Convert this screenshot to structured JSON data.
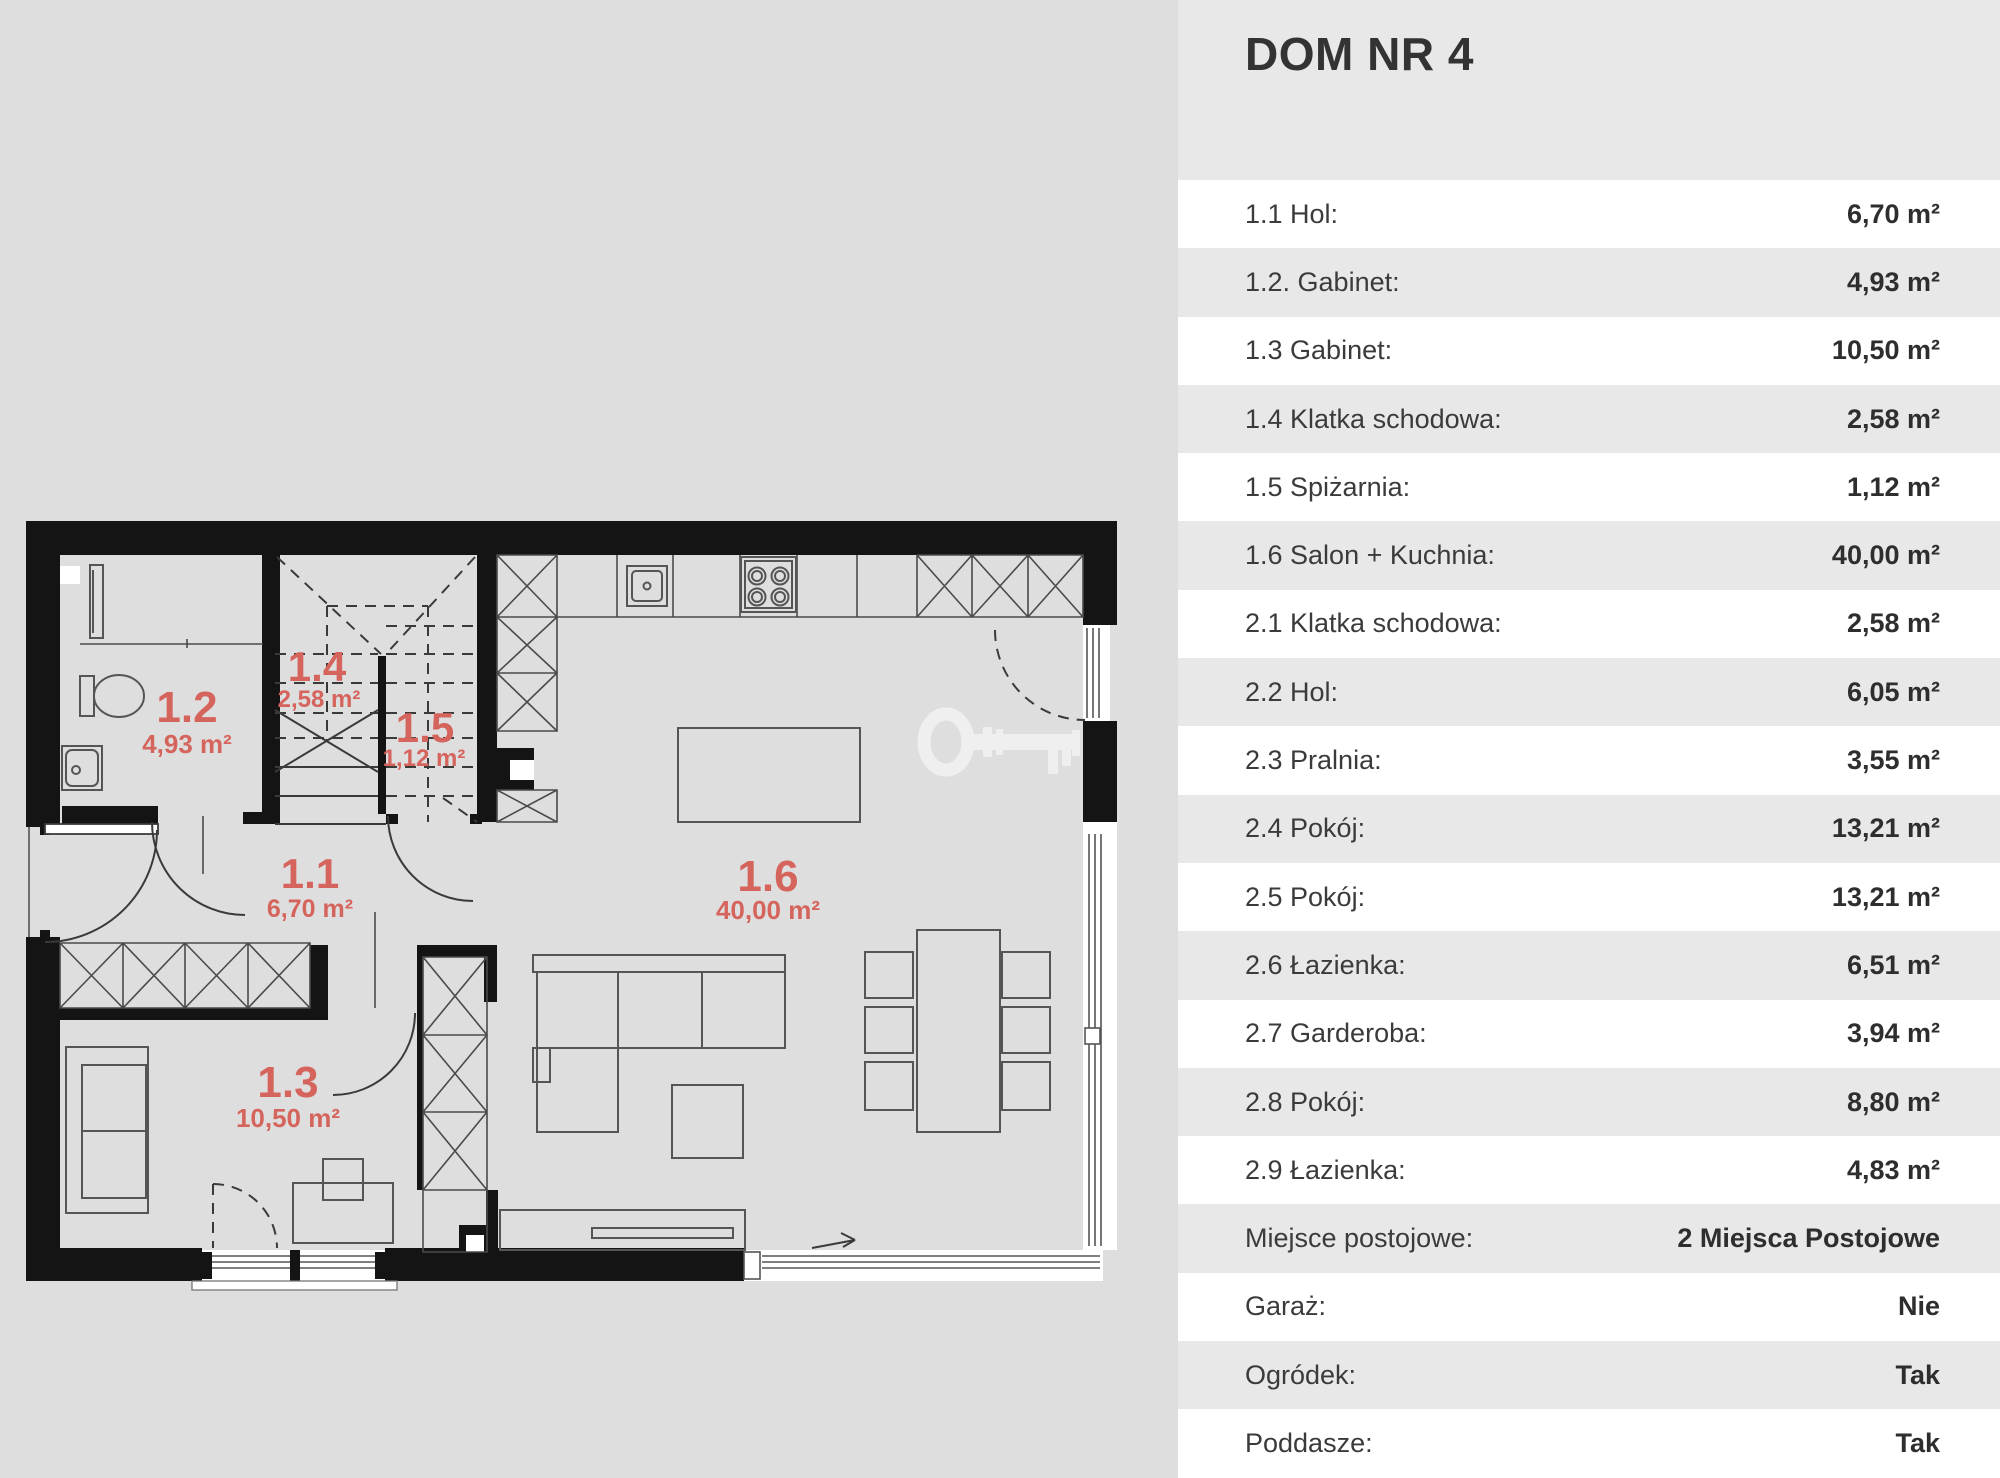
{
  "title": "DOM NR 4",
  "plan": {
    "rooms": [
      {
        "id": "1.1",
        "area": "6,70 m²"
      },
      {
        "id": "1.2",
        "area": "4,93 m²"
      },
      {
        "id": "1.3",
        "area": "10,50 m²"
      },
      {
        "id": "1.4",
        "area": "2,58 m²"
      },
      {
        "id": "1.5",
        "area": "1,12 m²"
      },
      {
        "id": "1.6",
        "area": "40,00 m²"
      }
    ],
    "watermark": "key-icon"
  },
  "table": {
    "rows": [
      {
        "label": "1.1 Hol:",
        "value": "6,70 m²"
      },
      {
        "label": "1.2. Gabinet:",
        "value": "4,93 m²"
      },
      {
        "label": "1.3 Gabinet:",
        "value": "10,50 m²"
      },
      {
        "label": "1.4 Klatka schodowa:",
        "value": "2,58 m²"
      },
      {
        "label": "1.5 Spiżarnia:",
        "value": "1,12 m²"
      },
      {
        "label": "1.6 Salon + Kuchnia:",
        "value": "40,00 m²"
      },
      {
        "label": "2.1 Klatka schodowa:",
        "value": "2,58 m²"
      },
      {
        "label": "2.2 Hol:",
        "value": "6,05 m²"
      },
      {
        "label": "2.3 Pralnia:",
        "value": "3,55 m²"
      },
      {
        "label": "2.4 Pokój:",
        "value": "13,21 m²"
      },
      {
        "label": "2.5 Pokój:",
        "value": "13,21 m²"
      },
      {
        "label": "2.6 Łazienka:",
        "value": "6,51 m²"
      },
      {
        "label": "2.7 Garderoba:",
        "value": "3,94 m²"
      },
      {
        "label": "2.8 Pokój:",
        "value": "8,80 m²"
      },
      {
        "label": "2.9 Łazienka:",
        "value": "4,83 m²"
      },
      {
        "label": "Miejsce postojowe:",
        "value": "2 Miejsca Postojowe"
      },
      {
        "label": "Garaż:",
        "value": "Nie"
      },
      {
        "label": "Ogródek:",
        "value": "Tak"
      },
      {
        "label": "Poddasze:",
        "value": "Tak"
      }
    ]
  },
  "colors": {
    "accent_red": "#d5645d",
    "wall_black": "#141414",
    "left_background": "#dedede",
    "panel_background": "#e8e8e8",
    "row_white": "#ffffff"
  }
}
